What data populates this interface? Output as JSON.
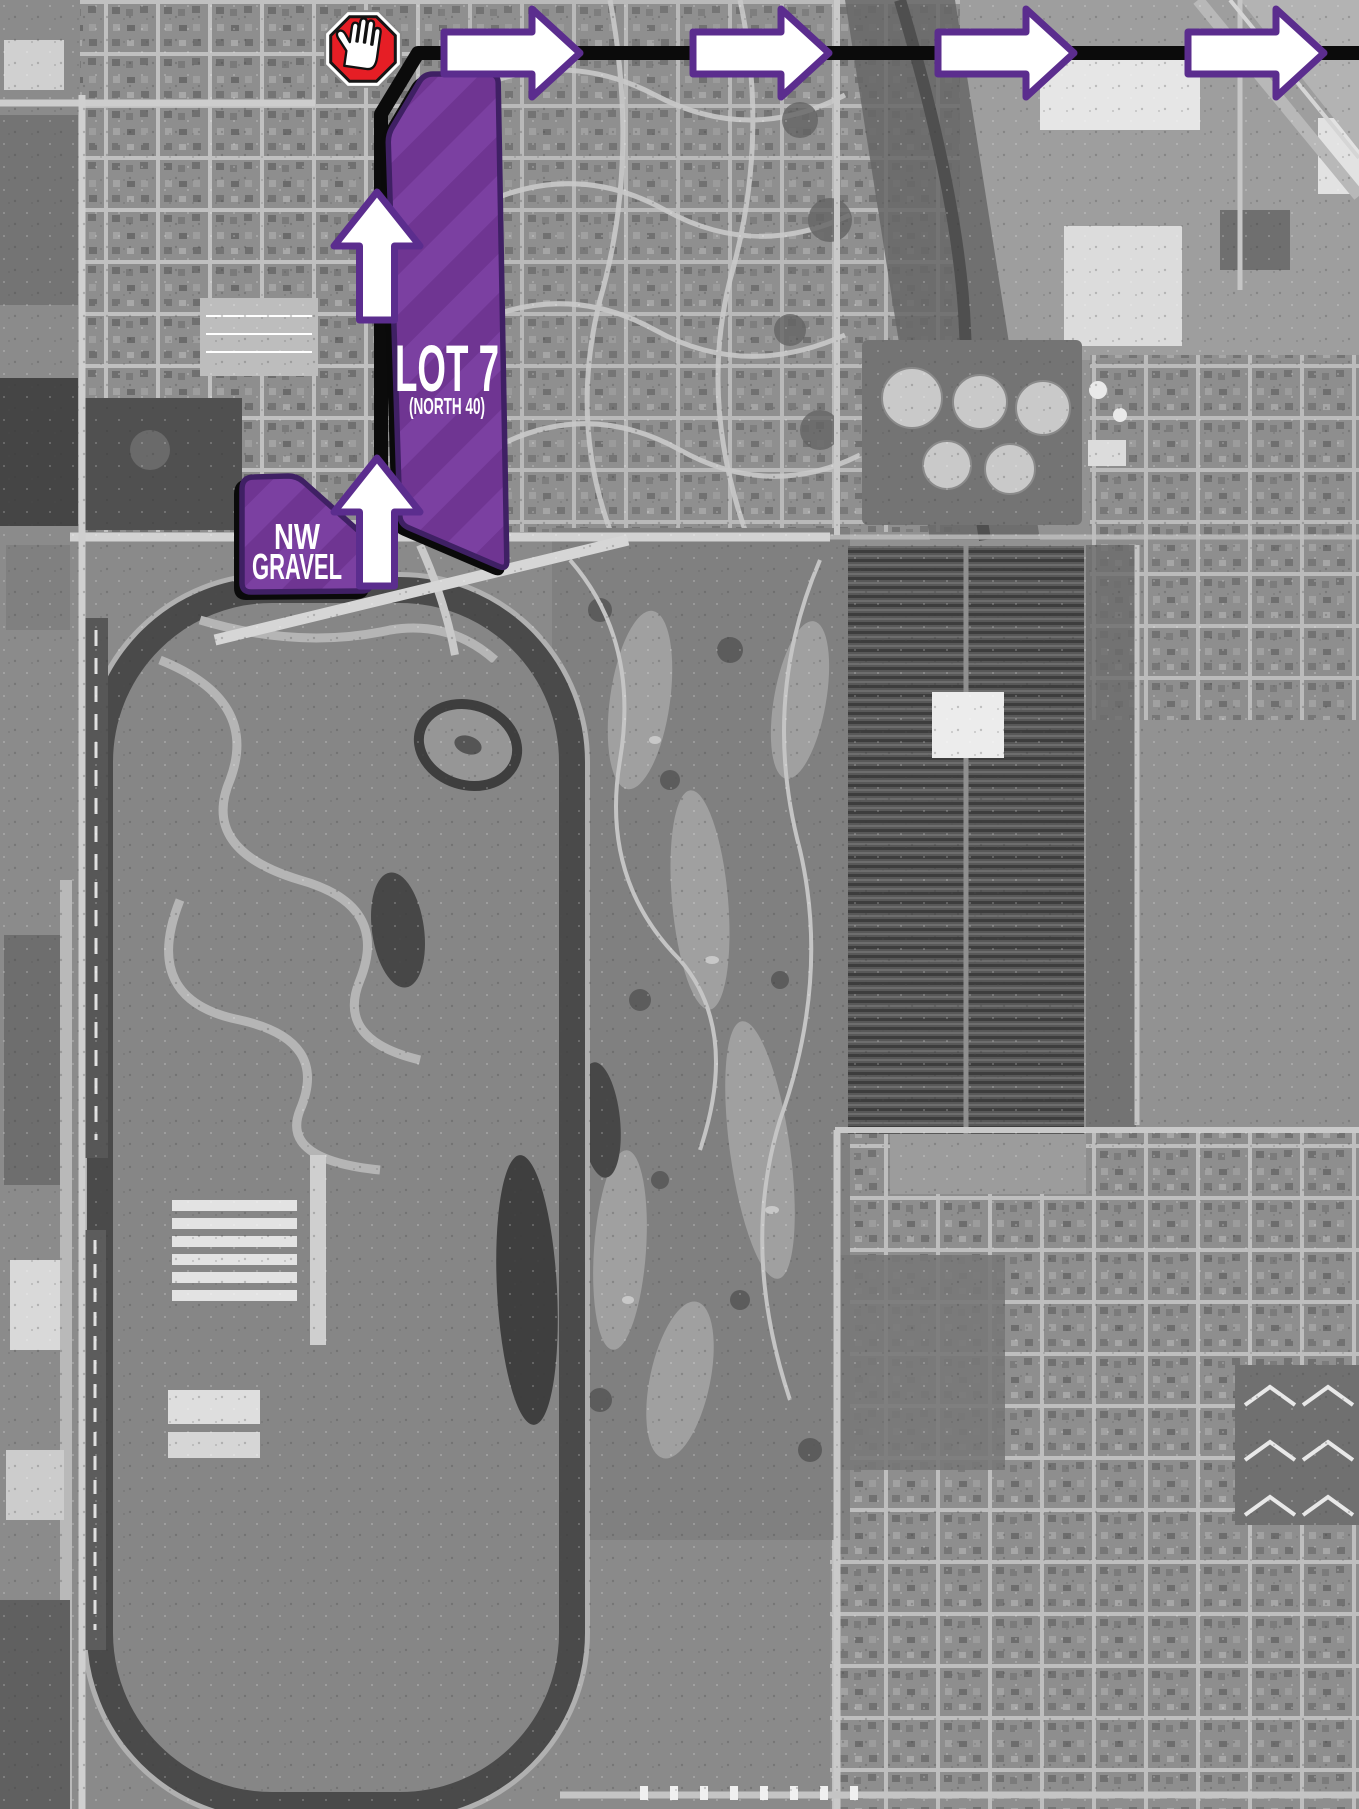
{
  "map": {
    "style": "grayscale-aerial",
    "features": {
      "speedway_oval": "race-track-oval",
      "golf_course": "golf-course",
      "solar_farm": "solar-panel-field",
      "gas_holders": "storage-tank-circles",
      "neighborhoods": "street-grid-blocks"
    }
  },
  "colors": {
    "lot_fill_light": "#7b40a1",
    "lot_fill_dark": "#6f3592",
    "lot_border": "#3f2064",
    "lot_shadow": "#0a0a0a",
    "arrow_fill": "#ffffff",
    "arrow_outline": "#5b2d8e",
    "route_line": "#0b0b0b",
    "stop_sign_red": "#e61e25",
    "stop_sign_ring": "#ffffff",
    "stop_sign_edge": "#161616",
    "hand": "#ffffff",
    "label_text": "#ffffff"
  },
  "lots": {
    "lot7": {
      "label": "LOT 7",
      "sublabel": "(NORTH 40)"
    },
    "nw_gravel": {
      "label_line1": "NW",
      "label_line2": "GRAVEL"
    }
  },
  "route": {
    "right_arrow_count": 4,
    "up_arrow_count": 2,
    "icons": {
      "stop": "stop-hand-icon",
      "right_arrow": "route-arrow-right-icon",
      "up_arrow": "route-arrow-up-icon"
    }
  }
}
